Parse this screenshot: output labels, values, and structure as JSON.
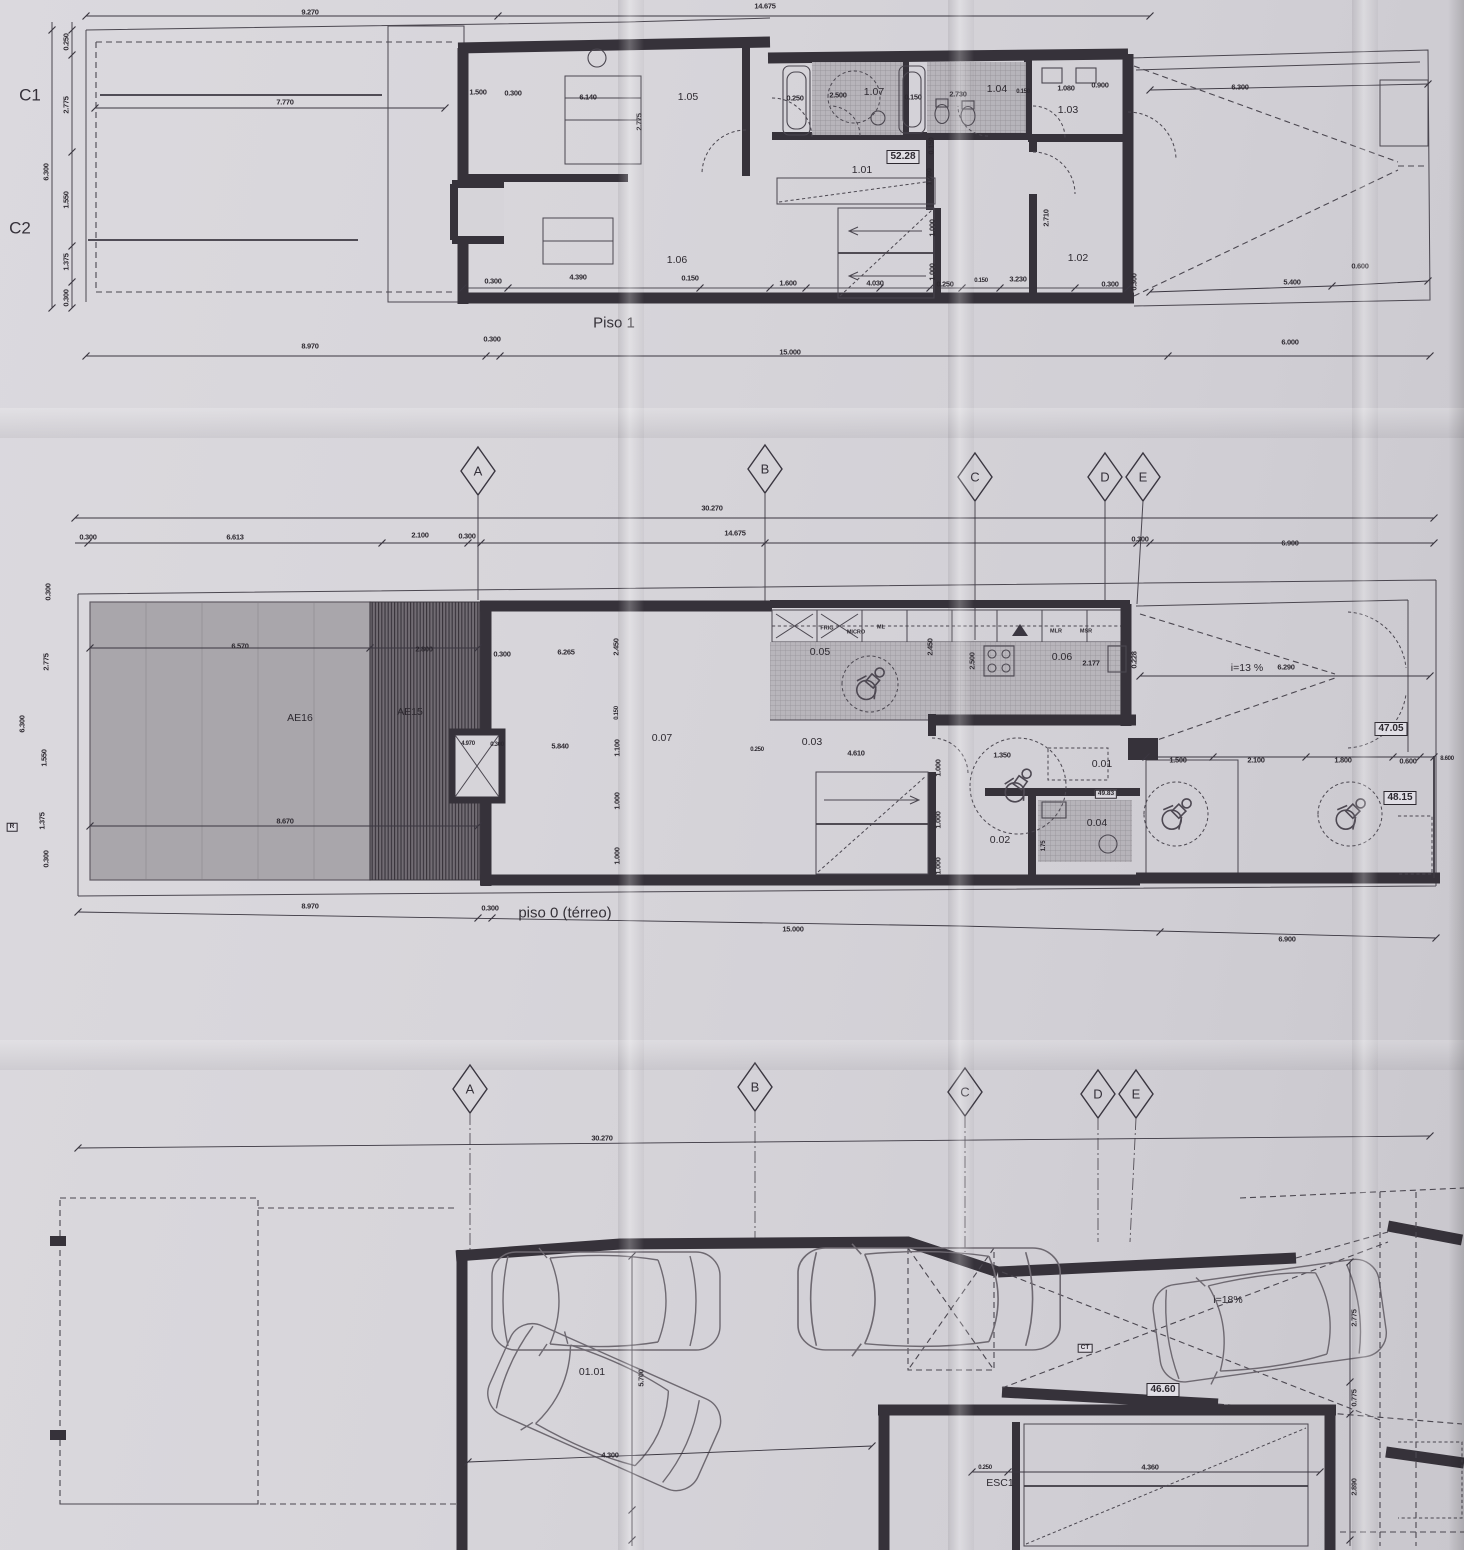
{
  "document_type": "scanned architectural floor plan sheet",
  "colors": {
    "paper": "#d6d4d9",
    "ink": "#36323a",
    "patio_gray": "#a9a6ab",
    "hatch_dark": "#716c73",
    "tile_gray": "#b5b2b8"
  },
  "grid_rows": [
    {
      "markers": [
        {
          "t": "A",
          "x": 478,
          "y": 471
        },
        {
          "t": "B",
          "x": 765,
          "y": 469
        },
        {
          "t": "C",
          "x": 975,
          "y": 477
        },
        {
          "t": "D",
          "x": 1105,
          "y": 477
        },
        {
          "t": "E",
          "x": 1143,
          "y": 477
        }
      ],
      "dims": [
        {
          "t": "30.270",
          "x": 712,
          "y": 508
        },
        {
          "t": "0.300",
          "x": 88,
          "y": 537
        },
        {
          "t": "6.613",
          "x": 235,
          "y": 537
        },
        {
          "t": "2.100",
          "x": 420,
          "y": 535
        },
        {
          "t": "0.300",
          "x": 467,
          "y": 536
        },
        {
          "t": "14.675",
          "x": 735,
          "y": 533
        },
        {
          "t": "0.300",
          "x": 1140,
          "y": 539
        },
        {
          "t": "6.900",
          "x": 1290,
          "y": 543
        }
      ]
    },
    {
      "markers": [
        {
          "t": "A",
          "x": 470,
          "y": 1089
        },
        {
          "t": "B",
          "x": 755,
          "y": 1087
        },
        {
          "t": "C",
          "x": 965,
          "y": 1092
        },
        {
          "t": "D",
          "x": 1098,
          "y": 1094
        },
        {
          "t": "E",
          "x": 1136,
          "y": 1094
        }
      ],
      "dims": [
        {
          "t": "30.270",
          "x": 602,
          "y": 1138
        }
      ]
    }
  ],
  "plans": [
    {
      "id": "piso1",
      "title": "Piso 1",
      "title_x": 614,
      "title_y": 323,
      "labels": [
        {
          "t": "9.270",
          "x": 310,
          "y": 12,
          "k": "dim"
        },
        {
          "t": "14.675",
          "x": 765,
          "y": 6,
          "k": "dim"
        },
        {
          "t": "C1",
          "x": 30,
          "y": 95,
          "k": "section"
        },
        {
          "t": "C2",
          "x": 20,
          "y": 228,
          "k": "section"
        },
        {
          "t": "7.770",
          "x": 285,
          "y": 102,
          "k": "dim"
        },
        {
          "t": "0.250",
          "x": 66,
          "y": 42,
          "k": "dim",
          "r": 1
        },
        {
          "t": "2.775",
          "x": 66,
          "y": 105,
          "k": "dim",
          "r": 1
        },
        {
          "t": "6.300",
          "x": 46,
          "y": 172,
          "k": "dim",
          "r": 1
        },
        {
          "t": "1.550",
          "x": 66,
          "y": 200,
          "k": "dim",
          "r": 1
        },
        {
          "t": "1.375",
          "x": 66,
          "y": 262,
          "k": "dim",
          "r": 1
        },
        {
          "t": "0.300",
          "x": 66,
          "y": 298,
          "k": "dim",
          "r": 1
        },
        {
          "t": "1.500",
          "x": 478,
          "y": 92,
          "k": "dim"
        },
        {
          "t": "0.300",
          "x": 513,
          "y": 93,
          "k": "dim"
        },
        {
          "t": "6.140",
          "x": 588,
          "y": 97,
          "k": "dim"
        },
        {
          "t": "1.05",
          "x": 688,
          "y": 97,
          "k": "room"
        },
        {
          "t": "2.775",
          "x": 639,
          "y": 122,
          "k": "dim",
          "r": 1
        },
        {
          "t": "0.250",
          "x": 795,
          "y": 98,
          "k": "dim"
        },
        {
          "t": "2.500",
          "x": 838,
          "y": 95,
          "k": "dim"
        },
        {
          "t": "1.07",
          "x": 874,
          "y": 92,
          "k": "room"
        },
        {
          "t": "0.150",
          "x": 913,
          "y": 97,
          "k": "dim"
        },
        {
          "t": "2.730",
          "x": 958,
          "y": 94,
          "k": "dim"
        },
        {
          "t": "1.04",
          "x": 997,
          "y": 89,
          "k": "room"
        },
        {
          "t": "0.150",
          "x": 1023,
          "y": 92,
          "k": "tiny"
        },
        {
          "t": "1.080",
          "x": 1066,
          "y": 88,
          "k": "dim"
        },
        {
          "t": "0.900",
          "x": 1100,
          "y": 85,
          "k": "dim"
        },
        {
          "t": "1.03",
          "x": 1068,
          "y": 110,
          "k": "room"
        },
        {
          "t": "52.28",
          "x": 903,
          "y": 157,
          "k": "box"
        },
        {
          "t": "1.01",
          "x": 862,
          "y": 170,
          "k": "room"
        },
        {
          "t": "0.150",
          "x": 931,
          "y": 146,
          "k": "dim",
          "r": 1
        },
        {
          "t": "1.780",
          "x": 929,
          "y": 177,
          "k": "dim",
          "r": 1
        },
        {
          "t": "1.000",
          "x": 932,
          "y": 228,
          "k": "dim",
          "r": 1
        },
        {
          "t": "1.000",
          "x": 932,
          "y": 272,
          "k": "dim",
          "r": 1
        },
        {
          "t": "2.710",
          "x": 1046,
          "y": 218,
          "k": "dim",
          "r": 1
        },
        {
          "t": "1.02",
          "x": 1078,
          "y": 258,
          "k": "room"
        },
        {
          "t": "1.06",
          "x": 677,
          "y": 260,
          "k": "room"
        },
        {
          "t": "0.300",
          "x": 493,
          "y": 281,
          "k": "dim"
        },
        {
          "t": "4.390",
          "x": 578,
          "y": 277,
          "k": "dim"
        },
        {
          "t": "0.150",
          "x": 690,
          "y": 278,
          "k": "dim"
        },
        {
          "t": "1.600",
          "x": 788,
          "y": 283,
          "k": "dim"
        },
        {
          "t": "4.030",
          "x": 875,
          "y": 283,
          "k": "dim"
        },
        {
          "t": "0.250",
          "x": 945,
          "y": 284,
          "k": "dim"
        },
        {
          "t": "0.150",
          "x": 981,
          "y": 281,
          "k": "tiny"
        },
        {
          "t": "3.230",
          "x": 1018,
          "y": 279,
          "k": "dim"
        },
        {
          "t": "0.300",
          "x": 1110,
          "y": 284,
          "k": "dim"
        },
        {
          "t": "6.300",
          "x": 1240,
          "y": 87,
          "k": "dim"
        },
        {
          "t": "5.400",
          "x": 1292,
          "y": 282,
          "k": "dim"
        },
        {
          "t": "0.600",
          "x": 1360,
          "y": 266,
          "k": "dim"
        },
        {
          "t": "0.300",
          "x": 1134,
          "y": 282,
          "k": "dim",
          "r": 1
        },
        {
          "t": "8.970",
          "x": 310,
          "y": 346,
          "k": "dim"
        },
        {
          "t": "0.300",
          "x": 492,
          "y": 339,
          "k": "dim"
        },
        {
          "t": "15.000",
          "x": 790,
          "y": 352,
          "k": "dim"
        },
        {
          "t": "6.000",
          "x": 1290,
          "y": 342,
          "k": "dim"
        }
      ]
    },
    {
      "id": "piso0",
      "title": "piso 0 (térreo)",
      "title_x": 565,
      "title_y": 913,
      "labels": [
        {
          "t": "AE16",
          "x": 300,
          "y": 718,
          "k": "room"
        },
        {
          "t": "AE15",
          "x": 410,
          "y": 712,
          "k": "room"
        },
        {
          "t": "6.570",
          "x": 240,
          "y": 646,
          "k": "dim"
        },
        {
          "t": "2.800",
          "x": 424,
          "y": 649,
          "k": "dim"
        },
        {
          "t": "8.670",
          "x": 285,
          "y": 821,
          "k": "dim"
        },
        {
          "t": "R",
          "x": 12,
          "y": 827,
          "k": "boxtiny"
        },
        {
          "t": "0.300",
          "x": 48,
          "y": 592,
          "k": "dim",
          "r": 1
        },
        {
          "t": "2.775",
          "x": 46,
          "y": 662,
          "k": "dim",
          "r": 1
        },
        {
          "t": "6.300",
          "x": 22,
          "y": 724,
          "k": "dim",
          "r": 1
        },
        {
          "t": "1.550",
          "x": 44,
          "y": 758,
          "k": "dim",
          "r": 1
        },
        {
          "t": "1.375",
          "x": 42,
          "y": 821,
          "k": "dim",
          "r": 1
        },
        {
          "t": "0.300",
          "x": 46,
          "y": 859,
          "k": "dim",
          "r": 1
        },
        {
          "t": "0.300",
          "x": 502,
          "y": 654,
          "k": "dim"
        },
        {
          "t": "6.265",
          "x": 566,
          "y": 652,
          "k": "dim"
        },
        {
          "t": "2.450",
          "x": 616,
          "y": 647,
          "k": "dim",
          "r": 1
        },
        {
          "t": "0.150",
          "x": 617,
          "y": 713,
          "k": "tiny",
          "r": 1
        },
        {
          "t": "1.100",
          "x": 617,
          "y": 748,
          "k": "dim",
          "r": 1
        },
        {
          "t": "1.000",
          "x": 617,
          "y": 801,
          "k": "dim",
          "r": 1
        },
        {
          "t": "1.000",
          "x": 617,
          "y": 856,
          "k": "dim",
          "r": 1
        },
        {
          "t": "0.07",
          "x": 662,
          "y": 738,
          "k": "room"
        },
        {
          "t": "5.840",
          "x": 560,
          "y": 746,
          "k": "dim"
        },
        {
          "t": "4.970",
          "x": 468,
          "y": 744,
          "k": "tiny"
        },
        {
          "t": "0.300",
          "x": 497,
          "y": 745,
          "k": "tiny"
        },
        {
          "t": "0.05",
          "x": 820,
          "y": 652,
          "k": "room"
        },
        {
          "t": "FRIG",
          "x": 827,
          "y": 629,
          "k": "app"
        },
        {
          "t": "MICRO",
          "x": 856,
          "y": 633,
          "k": "app"
        },
        {
          "t": "ML",
          "x": 881,
          "y": 628,
          "k": "app"
        },
        {
          "t": "2.450",
          "x": 930,
          "y": 647,
          "k": "dim",
          "r": 1
        },
        {
          "t": "2.500",
          "x": 972,
          "y": 661,
          "k": "dim",
          "r": 1
        },
        {
          "t": "0.06",
          "x": 1062,
          "y": 657,
          "k": "room"
        },
        {
          "t": "MLR",
          "x": 1056,
          "y": 632,
          "k": "app"
        },
        {
          "t": "MSR",
          "x": 1086,
          "y": 632,
          "k": "app"
        },
        {
          "t": "2.177",
          "x": 1091,
          "y": 663,
          "k": "dim"
        },
        {
          "t": "0.228",
          "x": 1134,
          "y": 660,
          "k": "dim",
          "r": 1
        },
        {
          "t": "i=13 %",
          "x": 1247,
          "y": 668,
          "k": "room"
        },
        {
          "t": "6.290",
          "x": 1286,
          "y": 667,
          "k": "dim"
        },
        {
          "t": "47.05",
          "x": 1391,
          "y": 729,
          "k": "box"
        },
        {
          "t": "0.03",
          "x": 812,
          "y": 742,
          "k": "room"
        },
        {
          "t": "4.610",
          "x": 856,
          "y": 753,
          "k": "dim"
        },
        {
          "t": "0.250",
          "x": 757,
          "y": 750,
          "k": "tiny"
        },
        {
          "t": "1.000",
          "x": 938,
          "y": 768,
          "k": "dim",
          "r": 1
        },
        {
          "t": "1.000",
          "x": 938,
          "y": 820,
          "k": "dim",
          "r": 1
        },
        {
          "t": "1.000",
          "x": 938,
          "y": 866,
          "k": "dim",
          "r": 1
        },
        {
          "t": "0.01",
          "x": 1102,
          "y": 764,
          "k": "room"
        },
        {
          "t": "1.350",
          "x": 1002,
          "y": 755,
          "k": "dim"
        },
        {
          "t": "49.83",
          "x": 1106,
          "y": 794,
          "k": "boxtiny"
        },
        {
          "t": "0.04",
          "x": 1097,
          "y": 823,
          "k": "room"
        },
        {
          "t": "0.02",
          "x": 1000,
          "y": 840,
          "k": "room"
        },
        {
          "t": "1.75",
          "x": 1044,
          "y": 846,
          "k": "tiny",
          "r": 1
        },
        {
          "t": "1.500",
          "x": 1178,
          "y": 760,
          "k": "dim"
        },
        {
          "t": "2.100",
          "x": 1256,
          "y": 760,
          "k": "dim"
        },
        {
          "t": "1.800",
          "x": 1343,
          "y": 760,
          "k": "dim"
        },
        {
          "t": "0.600",
          "x": 1408,
          "y": 761,
          "k": "dim"
        },
        {
          "t": "8.600",
          "x": 1447,
          "y": 759,
          "k": "tiny"
        },
        {
          "t": "48.15",
          "x": 1400,
          "y": 798,
          "k": "box"
        },
        {
          "t": "8.970",
          "x": 310,
          "y": 906,
          "k": "dim"
        },
        {
          "t": "0.300",
          "x": 490,
          "y": 908,
          "k": "dim"
        },
        {
          "t": "15.000",
          "x": 793,
          "y": 929,
          "k": "dim"
        },
        {
          "t": "6.900",
          "x": 1287,
          "y": 939,
          "k": "dim"
        }
      ]
    },
    {
      "id": "garagem",
      "labels": [
        {
          "t": "01.01",
          "x": 592,
          "y": 1372,
          "k": "room"
        },
        {
          "t": "5.700",
          "x": 641,
          "y": 1378,
          "k": "dim",
          "r": 1
        },
        {
          "t": "4.300",
          "x": 610,
          "y": 1455,
          "k": "dim"
        },
        {
          "t": "CT",
          "x": 1085,
          "y": 1348,
          "k": "boxtiny"
        },
        {
          "t": "46.60",
          "x": 1163,
          "y": 1390,
          "k": "box"
        },
        {
          "t": "ESC1",
          "x": 1000,
          "y": 1483,
          "k": "room"
        },
        {
          "t": "0.250",
          "x": 985,
          "y": 1468,
          "k": "tiny"
        },
        {
          "t": "4.360",
          "x": 1150,
          "y": 1467,
          "k": "dim"
        },
        {
          "t": "2.775",
          "x": 1354,
          "y": 1318,
          "k": "dim",
          "r": 1
        },
        {
          "t": "0.775",
          "x": 1354,
          "y": 1398,
          "k": "dim",
          "r": 1
        },
        {
          "t": "2.890",
          "x": 1354,
          "y": 1487,
          "k": "dim",
          "r": 1
        },
        {
          "t": "i=18%",
          "x": 1228,
          "y": 1300,
          "k": "room"
        }
      ]
    }
  ]
}
